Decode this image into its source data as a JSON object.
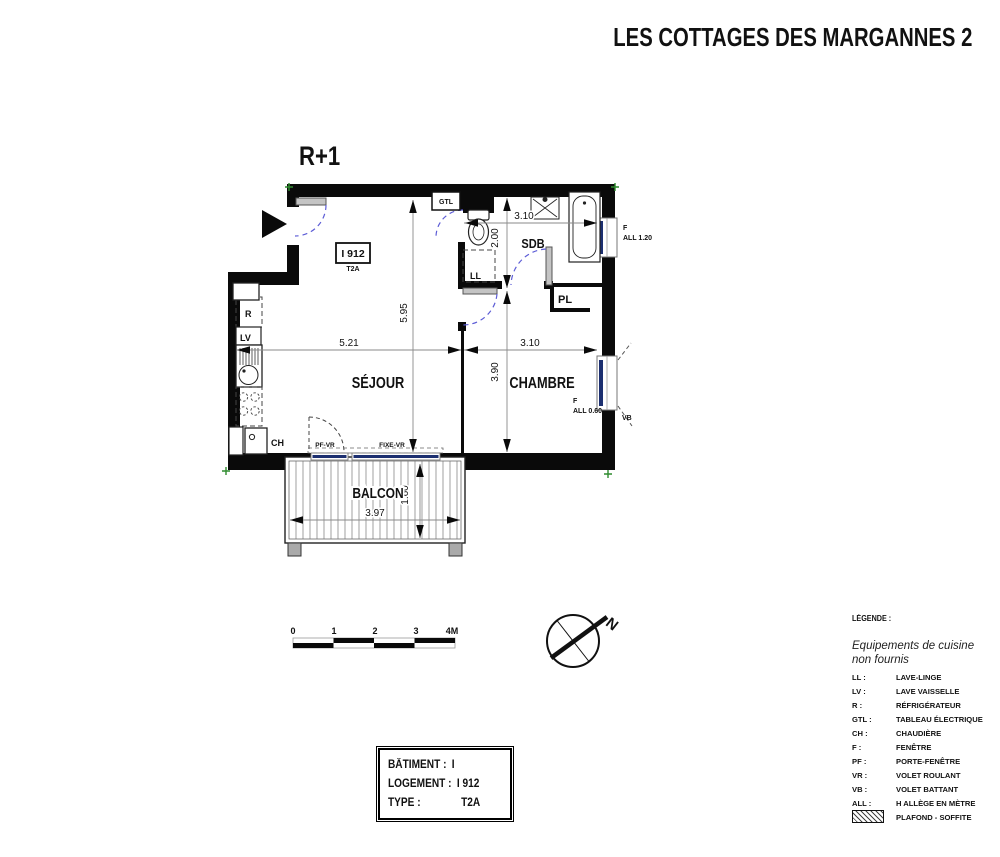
{
  "title": "LES COTTAGES DES MARGANNES 2",
  "floor_label": "R+1",
  "unit_tag": {
    "id": "I 912",
    "type": "T2A"
  },
  "rooms": {
    "sejour": "SÉJOUR",
    "chambre": "CHAMBRE",
    "sdb": "SDB",
    "balcon": "BALCON",
    "placard": "PL"
  },
  "equipment_labels": {
    "gtl": "GTL",
    "ll": "LL",
    "lv": "LV",
    "fridge": "R",
    "ch": "CH"
  },
  "openings": {
    "bath_window_type": "F",
    "bath_window_all": "ALL 1.20",
    "bedroom_window_type": "F",
    "bedroom_window_all": "ALL 0.60",
    "bedroom_shutter": "VB",
    "balcony_door": "PF-VR",
    "balcony_fixed": "FIXE-VR"
  },
  "dimensions": {
    "sejour_width": "5.21",
    "sejour_height": "5.95",
    "sdb_width": "3.10",
    "sdb_height": "2.00",
    "chambre_width": "3.10",
    "chambre_height": "3.90",
    "balcon_width": "3.97",
    "balcon_depth": "1.60"
  },
  "scale_bar": {
    "ticks": [
      "0",
      "1",
      "2",
      "3",
      "4M"
    ]
  },
  "compass": {
    "north": "N"
  },
  "legend": {
    "heading": "LÉGENDE :",
    "note_line1": "Equipements de cuisine",
    "note_line2": "non fournis",
    "items": [
      {
        "abbr": "LL :",
        "label": "LAVE-LINGE"
      },
      {
        "abbr": "LV :",
        "label": "LAVE VAISSELLE"
      },
      {
        "abbr": "R :",
        "label": "RÉFRIGÉRATEUR"
      },
      {
        "abbr": "GTL :",
        "label": "TABLEAU ÉLECTRIQUE"
      },
      {
        "abbr": "CH :",
        "label": "CHAUDIÈRE"
      },
      {
        "abbr": "F :",
        "label": "FENÊTRE"
      },
      {
        "abbr": "PF :",
        "label": "PORTE-FENÊTRE"
      },
      {
        "abbr": "VR :",
        "label": "VOLET ROULANT"
      },
      {
        "abbr": "VB :",
        "label": "VOLET BATTANT"
      },
      {
        "abbr": "ALL :",
        "label": "H ALLÈGE EN MÈTRE"
      }
    ],
    "hatch_label": "PLAFOND - SOFFITE"
  },
  "info_box": {
    "rows": [
      {
        "label": "BÂTIMENT :",
        "value": "I"
      },
      {
        "label": "LOGEMENT :",
        "value": "I 912"
      },
      {
        "label": "TYPE :",
        "value": "T2A"
      }
    ]
  },
  "colors": {
    "wall": "#0a0a0a",
    "door_swing_blue": "#5c5cd6",
    "glazing_navy": "#1c2f70",
    "corner_mark_green": "#2e8b2e",
    "dimension_line_gray": "#8a8a8a",
    "door_leaf_gray": "#b9b9b9"
  }
}
